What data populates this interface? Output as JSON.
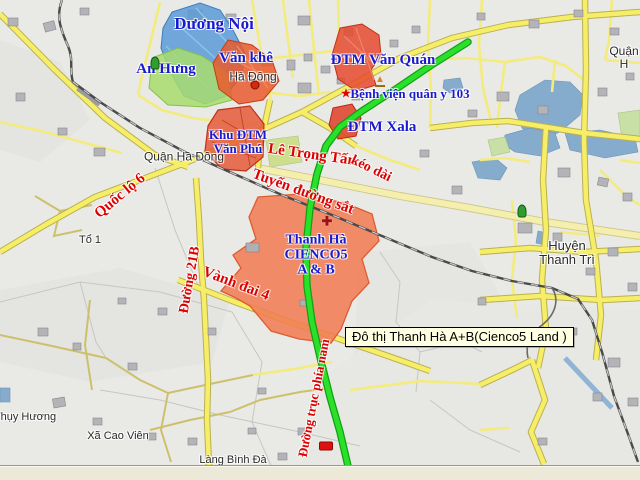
{
  "map": {
    "colors": {
      "background": "#e9e9e6",
      "place_label": "#1a1acd",
      "road_label": "#dd0000",
      "town_label": "#2a2a2a",
      "road_yellow": "#f7ee68",
      "green_route": "#2be02b",
      "railway": "#4a4a4a",
      "water": "#85abcd",
      "area_blue": "#5b9ad6",
      "area_green": "#a8dc6d",
      "area_orange": "#f17c54",
      "area_red": "#e64a2e",
      "tooltip_bg": "#ffffe1"
    },
    "labels": [
      {
        "id": "duong-noi",
        "text": "Dương Nội",
        "x": 214,
        "y": 24,
        "size": 17,
        "rot": 0,
        "style": "place"
      },
      {
        "id": "van-khe",
        "text": "Văn khê",
        "x": 246,
        "y": 58,
        "size": 15,
        "rot": 0,
        "style": "place"
      },
      {
        "id": "an-hung",
        "text": "An Hưng",
        "x": 166,
        "y": 69,
        "size": 15,
        "rot": 0,
        "style": "place"
      },
      {
        "id": "ha-dong-town",
        "text": "Hà Đông",
        "x": 253,
        "y": 77,
        "size": 12,
        "rot": 0,
        "style": "town"
      },
      {
        "id": "dtm-van-quan",
        "text": "ĐTM Văn Quán",
        "x": 383,
        "y": 60,
        "size": 15,
        "rot": 0,
        "style": "place"
      },
      {
        "id": "benh-vien-quan-y-103",
        "text": "Bệnh viện quân y 103",
        "x": 410,
        "y": 94,
        "size": 13,
        "rot": 0,
        "style": "place"
      },
      {
        "id": "dtm-xala",
        "text": "ĐTM Xala",
        "x": 382,
        "y": 127,
        "size": 15,
        "rot": 0,
        "style": "place"
      },
      {
        "id": "khu-dtm-van-phu",
        "text": "Khu ĐTM\nVăn Phú",
        "x": 238,
        "y": 142,
        "size": 13,
        "rot": 0,
        "style": "place"
      },
      {
        "id": "quan-ha-dong",
        "text": "Quận Hà Đông",
        "x": 184,
        "y": 157,
        "size": 12,
        "rot": 0,
        "style": "town"
      },
      {
        "id": "le-trong-tan",
        "text": "Lê Trọng Tấn",
        "x": 312,
        "y": 155,
        "size": 15,
        "rot": 8,
        "style": "road"
      },
      {
        "id": "keo-dai",
        "text": "kéo dài",
        "x": 371,
        "y": 169,
        "size": 14,
        "rot": 26,
        "style": "road"
      },
      {
        "id": "tuyen-duong-sat",
        "text": "Tuyến đường sắt",
        "x": 303,
        "y": 192,
        "size": 15,
        "rot": 20,
        "style": "road"
      },
      {
        "id": "quoc-lo-6",
        "text": "Quốc lộ 6",
        "x": 120,
        "y": 196,
        "size": 15,
        "rot": -40,
        "style": "road"
      },
      {
        "id": "to-1",
        "text": "Tổ 1",
        "x": 90,
        "y": 241,
        "size": 11,
        "rot": 0,
        "style": "town"
      },
      {
        "id": "thanh-ha-cienco5",
        "text": "Thanh Hà\nCIENCO5\nA & B",
        "x": 316,
        "y": 255,
        "size": 14,
        "rot": 0,
        "style": "place"
      },
      {
        "id": "duong-21b",
        "text": "Đường 21B",
        "x": 190,
        "y": 280,
        "size": 14,
        "rot": -80,
        "style": "road"
      },
      {
        "id": "vanh-dai-4",
        "text": "Vành đai 4",
        "x": 236,
        "y": 284,
        "size": 15,
        "rot": 21,
        "style": "road"
      },
      {
        "id": "huyen-thanh-tri",
        "text": "Huyện Thanh Trì",
        "x": 567,
        "y": 253,
        "size": 13,
        "rot": 0,
        "style": "town"
      },
      {
        "id": "quan-h",
        "text": "Quận H",
        "x": 624,
        "y": 58,
        "size": 12,
        "rot": 0,
        "style": "town"
      },
      {
        "id": "duong-truc-phia-nam",
        "text": "Đường trục phía nam",
        "x": 314,
        "y": 398,
        "size": 13,
        "rot": -79,
        "style": "road"
      },
      {
        "id": "thuy-huong",
        "text": "Thụy Hương",
        "x": 25,
        "y": 418,
        "size": 11,
        "rot": 0,
        "style": "town"
      },
      {
        "id": "xa-cao-vien",
        "text": "Xã Cao Viên",
        "x": 118,
        "y": 437,
        "size": 11,
        "rot": 0,
        "style": "town"
      },
      {
        "id": "lang-binh-da",
        "text": "Làng Bình Đà",
        "x": 233,
        "y": 461,
        "size": 11,
        "rot": 0,
        "style": "town"
      }
    ],
    "markers": [
      {
        "id": "ha-dong-dot",
        "type": "dot",
        "x": 255,
        "y": 85,
        "glyph": ""
      },
      {
        "id": "hospital-star",
        "type": "star",
        "x": 346,
        "y": 93,
        "glyph": "★"
      },
      {
        "id": "pagoda",
        "type": "pagoda",
        "x": 380,
        "y": 81,
        "glyph": "▲"
      },
      {
        "id": "church-cross",
        "type": "cross",
        "x": 327,
        "y": 221,
        "glyph": "✚"
      },
      {
        "id": "monument-green-1",
        "type": "green",
        "x": 155,
        "y": 63,
        "glyph": ""
      },
      {
        "id": "monument-green-2",
        "type": "green",
        "x": 522,
        "y": 211,
        "glyph": ""
      },
      {
        "id": "car",
        "type": "car",
        "x": 326,
        "y": 446,
        "glyph": ""
      }
    ],
    "tooltip": {
      "text": "Đô thị Thanh Hà A+B(Cienco5 Land )"
    }
  }
}
